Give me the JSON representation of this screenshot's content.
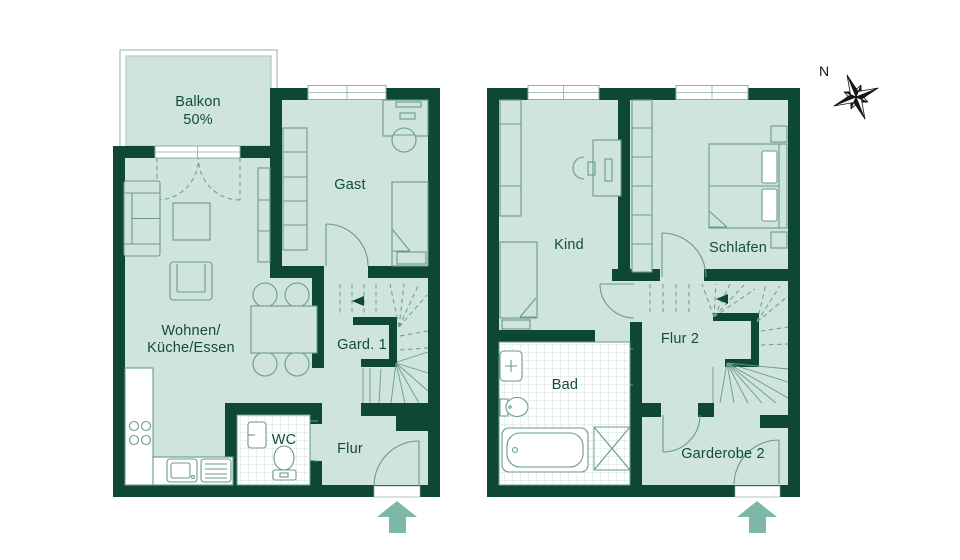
{
  "colors": {
    "background": "#ffffff",
    "wall": "#0e4833",
    "floor": "#cfe4dd",
    "furniture_line": "#6a9a8e",
    "tile_line": "#c5d9d3",
    "balcony_outline": "#aec4bd",
    "window_line": "#93aca5",
    "label": "#124c3a",
    "arrow": "#7cb7a7",
    "compass_dark": "#161616"
  },
  "ground_floor": {
    "labels": {
      "balcony_line1": "Balkon",
      "balcony_line2": "50%",
      "guest_room": "Gast",
      "living_line1": "Wohnen/",
      "living_line2": "Küche/Essen",
      "wardrobe1": "Gard. 1",
      "wc": "WC",
      "hallway": "Flur"
    }
  },
  "upper_floor": {
    "labels": {
      "child_room": "Kind",
      "bedroom": "Schlafen",
      "hallway2": "Flur 2",
      "bathroom": "Bad",
      "wardrobe2": "Garderobe 2"
    }
  },
  "compass": {
    "north": "N"
  }
}
